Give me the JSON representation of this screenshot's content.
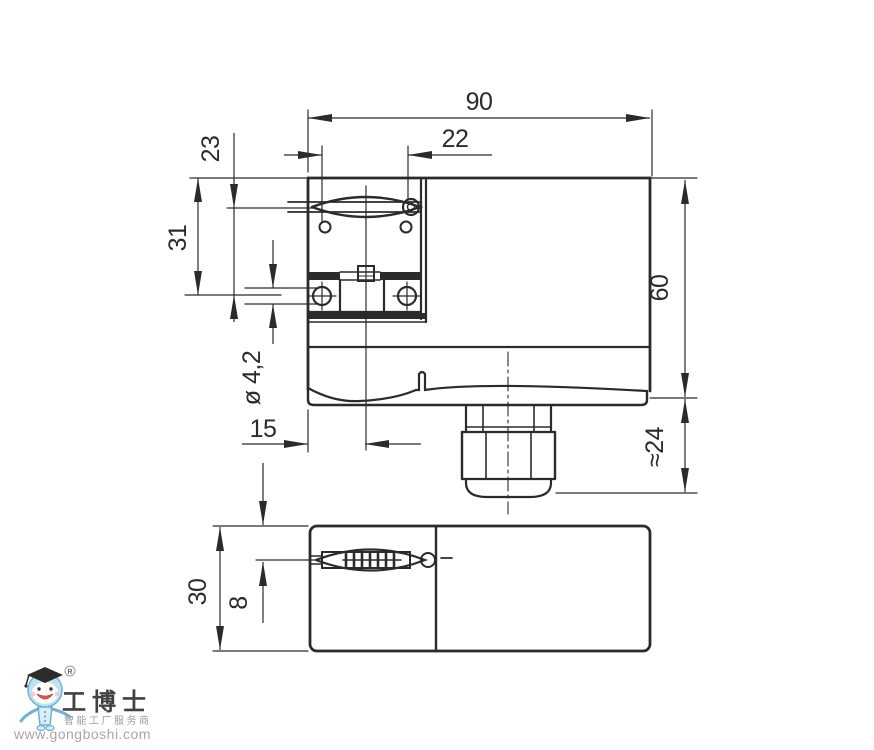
{
  "drawing": {
    "dimensions": {
      "width_total": "90",
      "hole_spacing": "22",
      "slot_to_hole": "23",
      "top_to_hole": "31",
      "hole_dia": "ø 4,2",
      "edge_to_center": "15",
      "height_total": "60",
      "gland_height": "≈24",
      "depth_total": "30",
      "slot_depth_offset": "8"
    }
  },
  "watermark": {
    "brand_cn": "工博士",
    "registered_mark": "R",
    "tagline_cn": "智能工厂服务商",
    "url": "www.gongboshi.com"
  },
  "colors": {
    "line": "#2b2b2b",
    "background": "#ffffff",
    "logo_blue": "#bfe2f1",
    "logo_blue_dark": "#6fb3d2",
    "logo_gray": "#9c9c9c",
    "logo_red": "#e2574c"
  }
}
